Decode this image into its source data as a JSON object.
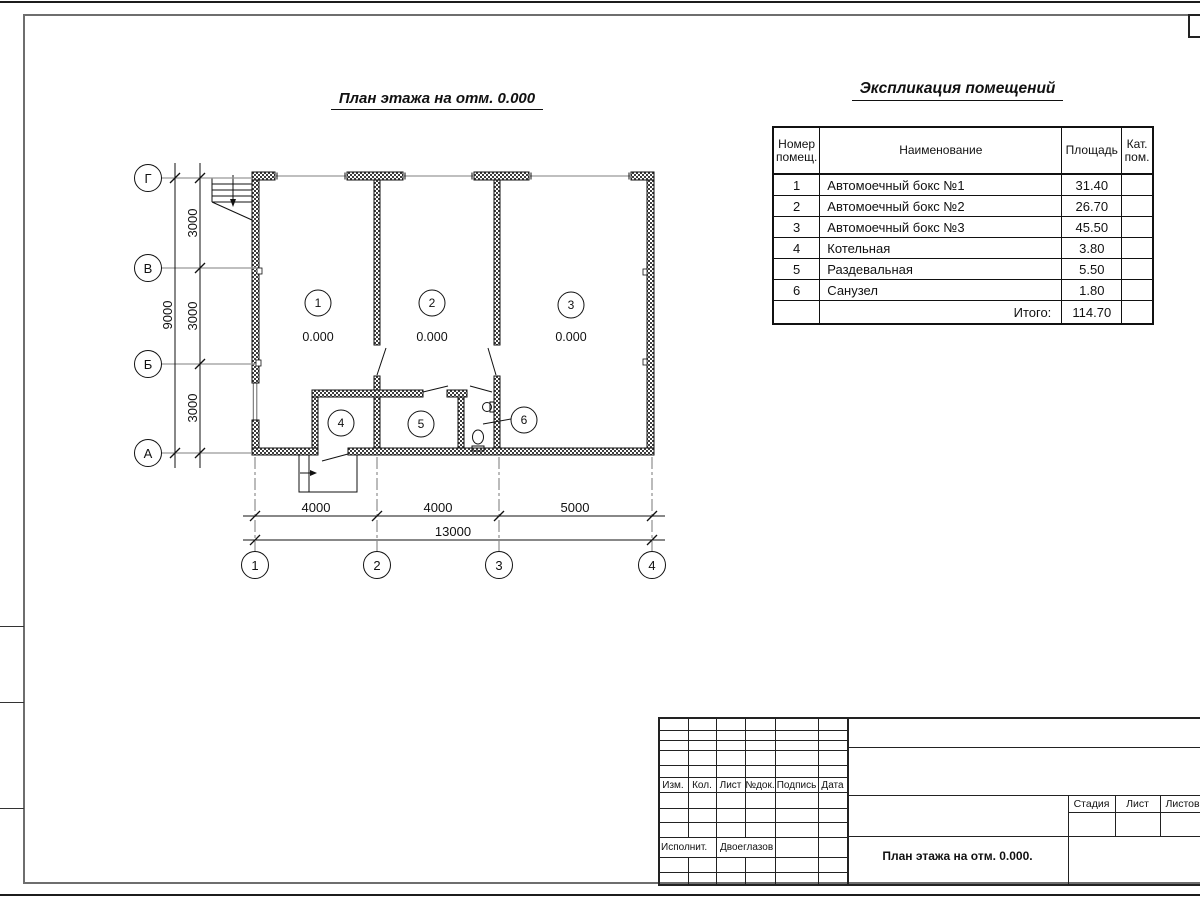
{
  "sheet": {
    "plan_title": "План этажа на отм. 0.000",
    "explication_title": "Экспликация помещений"
  },
  "plan": {
    "elevation": "0.000",
    "room_numbers": [
      "1",
      "2",
      "3",
      "4",
      "5",
      "6"
    ],
    "axis_letters": [
      "Г",
      "В",
      "Б",
      "А"
    ],
    "axis_numbers": [
      "1",
      "2",
      "3",
      "4"
    ],
    "dim_v_segments": [
      "3000",
      "3000",
      "3000"
    ],
    "dim_v_total": "9000",
    "dim_h_segments": [
      "4000",
      "4000",
      "5000"
    ],
    "dim_h_total": "13000"
  },
  "explication": {
    "headers": {
      "num": "Номер помещ.",
      "name": "Наименование",
      "area": "Площадь",
      "cat": "Кат. пом."
    },
    "rows": [
      {
        "num": "1",
        "name": "Автомоечный бокс №1",
        "area": "31.40"
      },
      {
        "num": "2",
        "name": "Автомоечный бокс №2",
        "area": "26.70"
      },
      {
        "num": "3",
        "name": "Автомоечный бокс №3",
        "area": "45.50"
      },
      {
        "num": "4",
        "name": "Котельная",
        "area": "3.80"
      },
      {
        "num": "5",
        "name": "Раздевальная",
        "area": "5.50"
      },
      {
        "num": "6",
        "name": "Санузел",
        "area": "1.80"
      }
    ],
    "total_label": "Итого:",
    "total_value": "114.70"
  },
  "title_block": {
    "col_labels": [
      "Изм.",
      "Кол.",
      "Лист",
      "№док.",
      "Подпись",
      "Дата"
    ],
    "executor_label": "Исполнит.",
    "executor_name": "Двоеглазов",
    "stage_label": "Стадия",
    "sheet_label": "Лист",
    "sheets_label": "Листов",
    "doc_title": "План этажа на отм. 0.000."
  }
}
